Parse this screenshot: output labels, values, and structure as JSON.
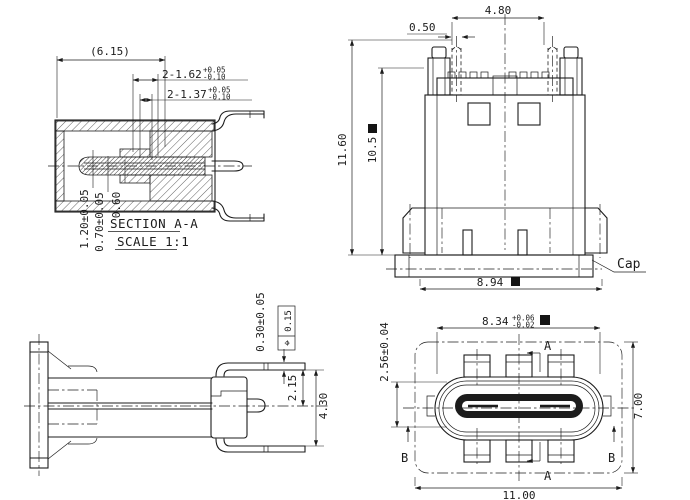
{
  "drawing": {
    "kind": "connector engineering drawing",
    "background": "#ffffff",
    "ink": "#1c1c1c",
    "views": {
      "section_aa": {
        "title": "SECTION A-A",
        "scale": "SCALE 1:1",
        "dim_overall": "(6.15)",
        "dim_pin1": "2-1.62",
        "dim_pin1_plus": "+0.05",
        "dim_pin1_minus": "-0.10",
        "dim_pin2": "2-1.37",
        "dim_pin2_plus": "+0.05",
        "dim_pin2_minus": "-0.10",
        "dim_t1": "1.20±0.05",
        "dim_t2": "0.70±0.05",
        "dim_t3": "0.60"
      },
      "front": {
        "dim_top_width": "4.80",
        "dim_pin": "0.50",
        "dim_height": "11.60",
        "dim_body_height": "10.5",
        "dim_cap_width": "8.94",
        "cap_label": "Cap"
      },
      "side": {
        "dim_standoff": "0.30±0.05",
        "fcf_symbol": "⌖",
        "fcf_value": "0.15",
        "dim_pitch": "2.15",
        "dim_depth": "4.30"
      },
      "bottom": {
        "dim_shell": "8.34",
        "dim_shell_plus": "+0.06",
        "dim_shell_minus": "-0.02",
        "dim_shell_h": "2.56±0.04",
        "dim_body_h": "7.00",
        "dim_overall": "11.00",
        "marker_a": "A",
        "marker_b": "B"
      }
    }
  }
}
